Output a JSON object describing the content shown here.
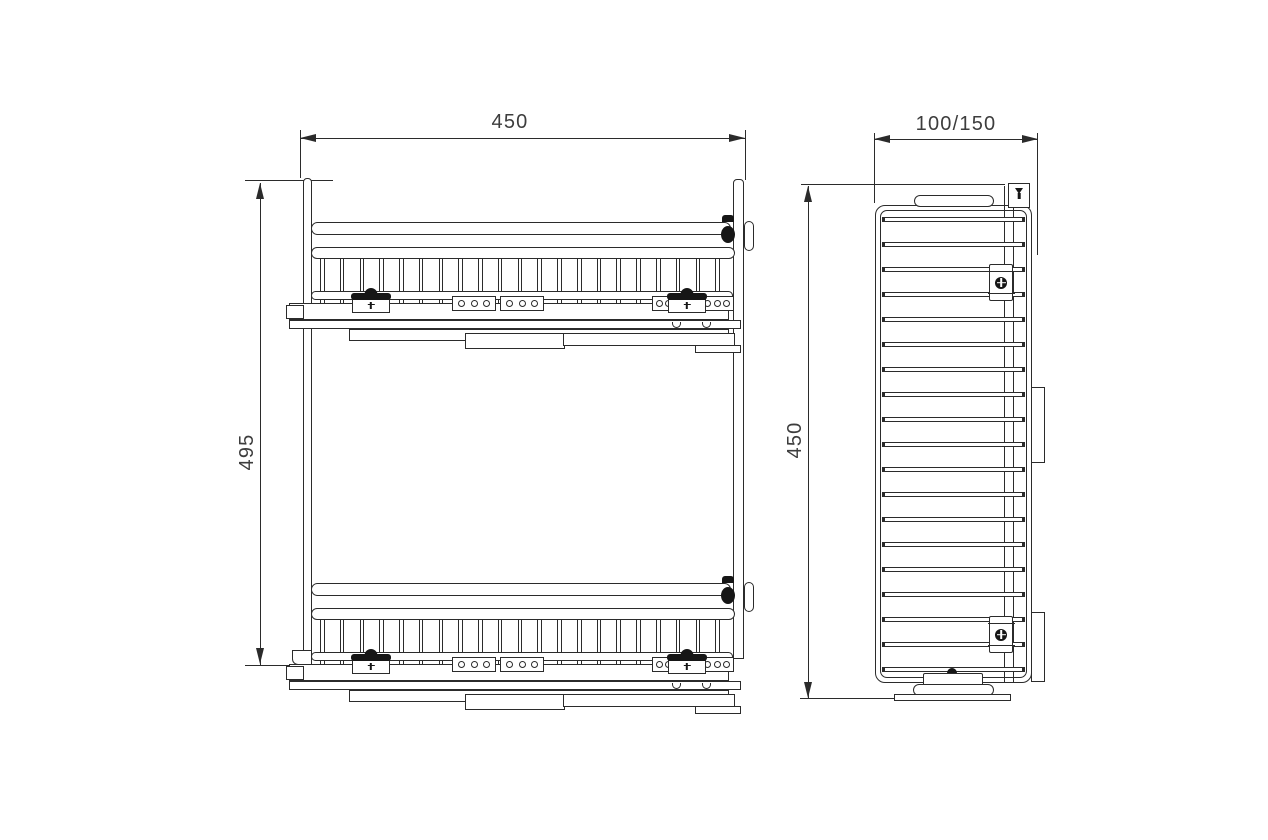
{
  "drawing": {
    "background_color": "#ffffff",
    "line_color": "#2b2b2b",
    "text_color": "#3d3d3d",
    "front_view": {
      "width_dim": "450",
      "height_dim": "495",
      "basket_count": 2,
      "wire_count": 21,
      "plate_hole_count_small": 3,
      "plate_hole_count_large": 8
    },
    "side_view": {
      "width_dim": "100/150",
      "height_dim": "450",
      "rung_count": 19
    }
  }
}
